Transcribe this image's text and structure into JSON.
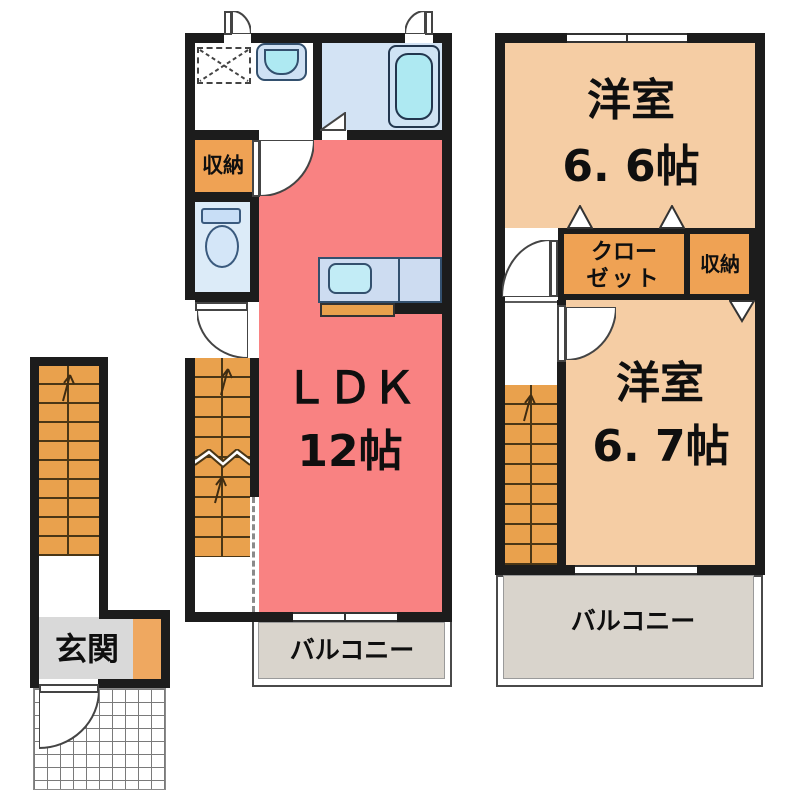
{
  "title": "2-story apartment floor plan",
  "colors": {
    "wall": "#1c1c1c",
    "ldk": "#f98282",
    "peach": "#f5cda4",
    "stairs": "#e9a14d",
    "storage": "#efa254",
    "counter": "#cddcf1",
    "sink": "#c2ecf6",
    "bath": "#d3e3f4",
    "tub": "#aee9f2",
    "toiletroom": "#dcebf8",
    "balcony": "#d9d4cc",
    "genkan": "#d9d9d9",
    "shoebox": "#efa860",
    "stepline": "#4a3616"
  },
  "entrance_unit": {
    "genkan_label": "玄関"
  },
  "floor1": {
    "storage_label": "収納",
    "ldk_label": "ＬＤＫ",
    "ldk_size": "12帖",
    "balcony_label": "バルコニー"
  },
  "floor2": {
    "room_a_label": "洋室",
    "room_a_size": "6. 6帖",
    "closet_line1": "クロー",
    "closet_line2": "ゼット",
    "storage_label": "収納",
    "room_b_label": "洋室",
    "room_b_size": "6. 7帖",
    "balcony_label": "バルコニー"
  }
}
